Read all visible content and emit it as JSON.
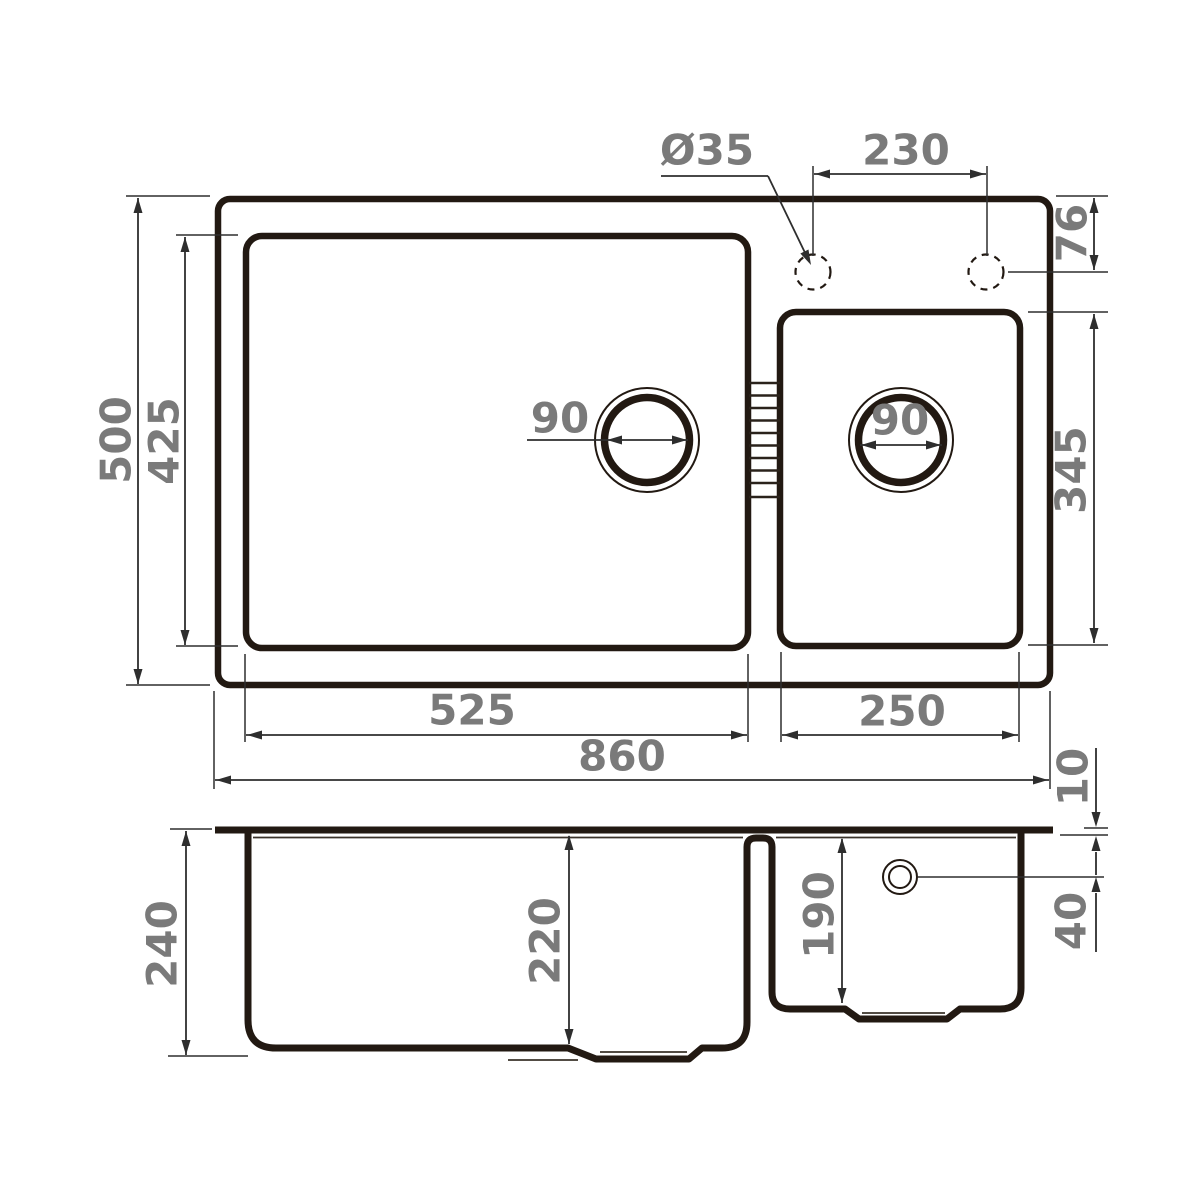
{
  "figure": {
    "kind": "technical dimension drawing",
    "subject": "double-bowl kitchen sink, top view and cross-section view"
  },
  "dims": {
    "faucet_hole_diameter": "Ø35",
    "faucet_hole_spacing": "230",
    "faucet_hole_offset": "76",
    "overall_depth": "500",
    "bowls_depth_plan": "425",
    "main_drain_diameter": "90",
    "small_drain_diameter": "90",
    "small_bowl_length": "345",
    "main_bowl_width": "525",
    "small_bowl_width": "250",
    "overall_width": "860",
    "rim_thickness": "10",
    "total_height": "240",
    "main_bowl_depth": "220",
    "small_bowl_depth": "190",
    "overflow_offset": "40"
  },
  "colors": {
    "outline": "#221912",
    "dimension_lines": "#2e2e2e",
    "labels": "#7a7a7a",
    "background": "#ffffff"
  }
}
